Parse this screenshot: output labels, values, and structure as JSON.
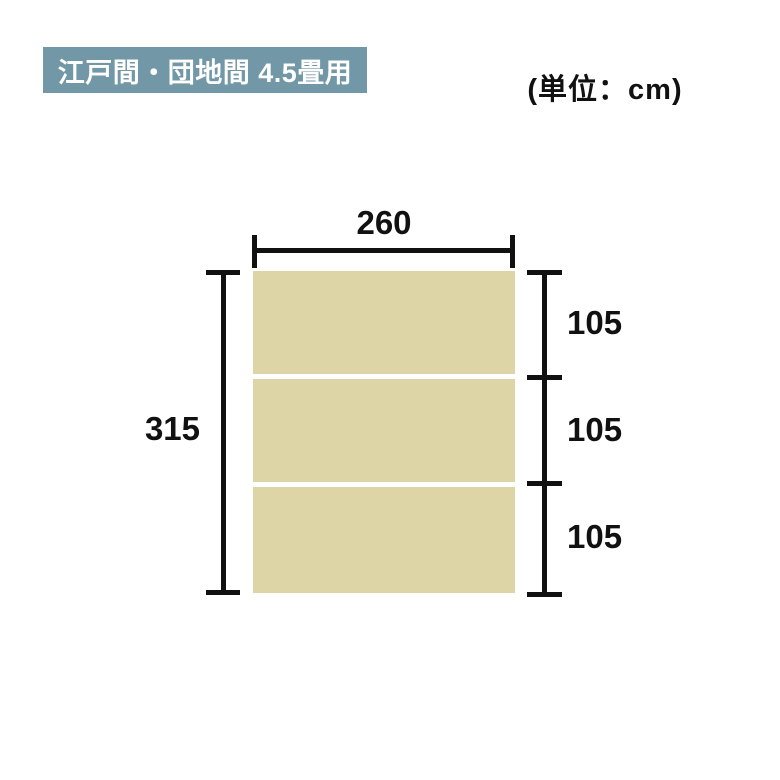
{
  "colors": {
    "background": "#ffffff",
    "badge_bg": "#7297a6",
    "badge_text": "#ffffff",
    "panel_fill": "#ded5a6",
    "line_color": "#111111"
  },
  "header": {
    "badge_label": "江戸間・団地間 4.5畳用",
    "unit_label": "(単位：cm)"
  },
  "diagram": {
    "type": "rug-dimension-diagram",
    "unit": "cm",
    "overall_width": "260",
    "overall_height": "315",
    "sections": [
      {
        "label": "105"
      },
      {
        "label": "105"
      },
      {
        "label": "105"
      }
    ]
  }
}
